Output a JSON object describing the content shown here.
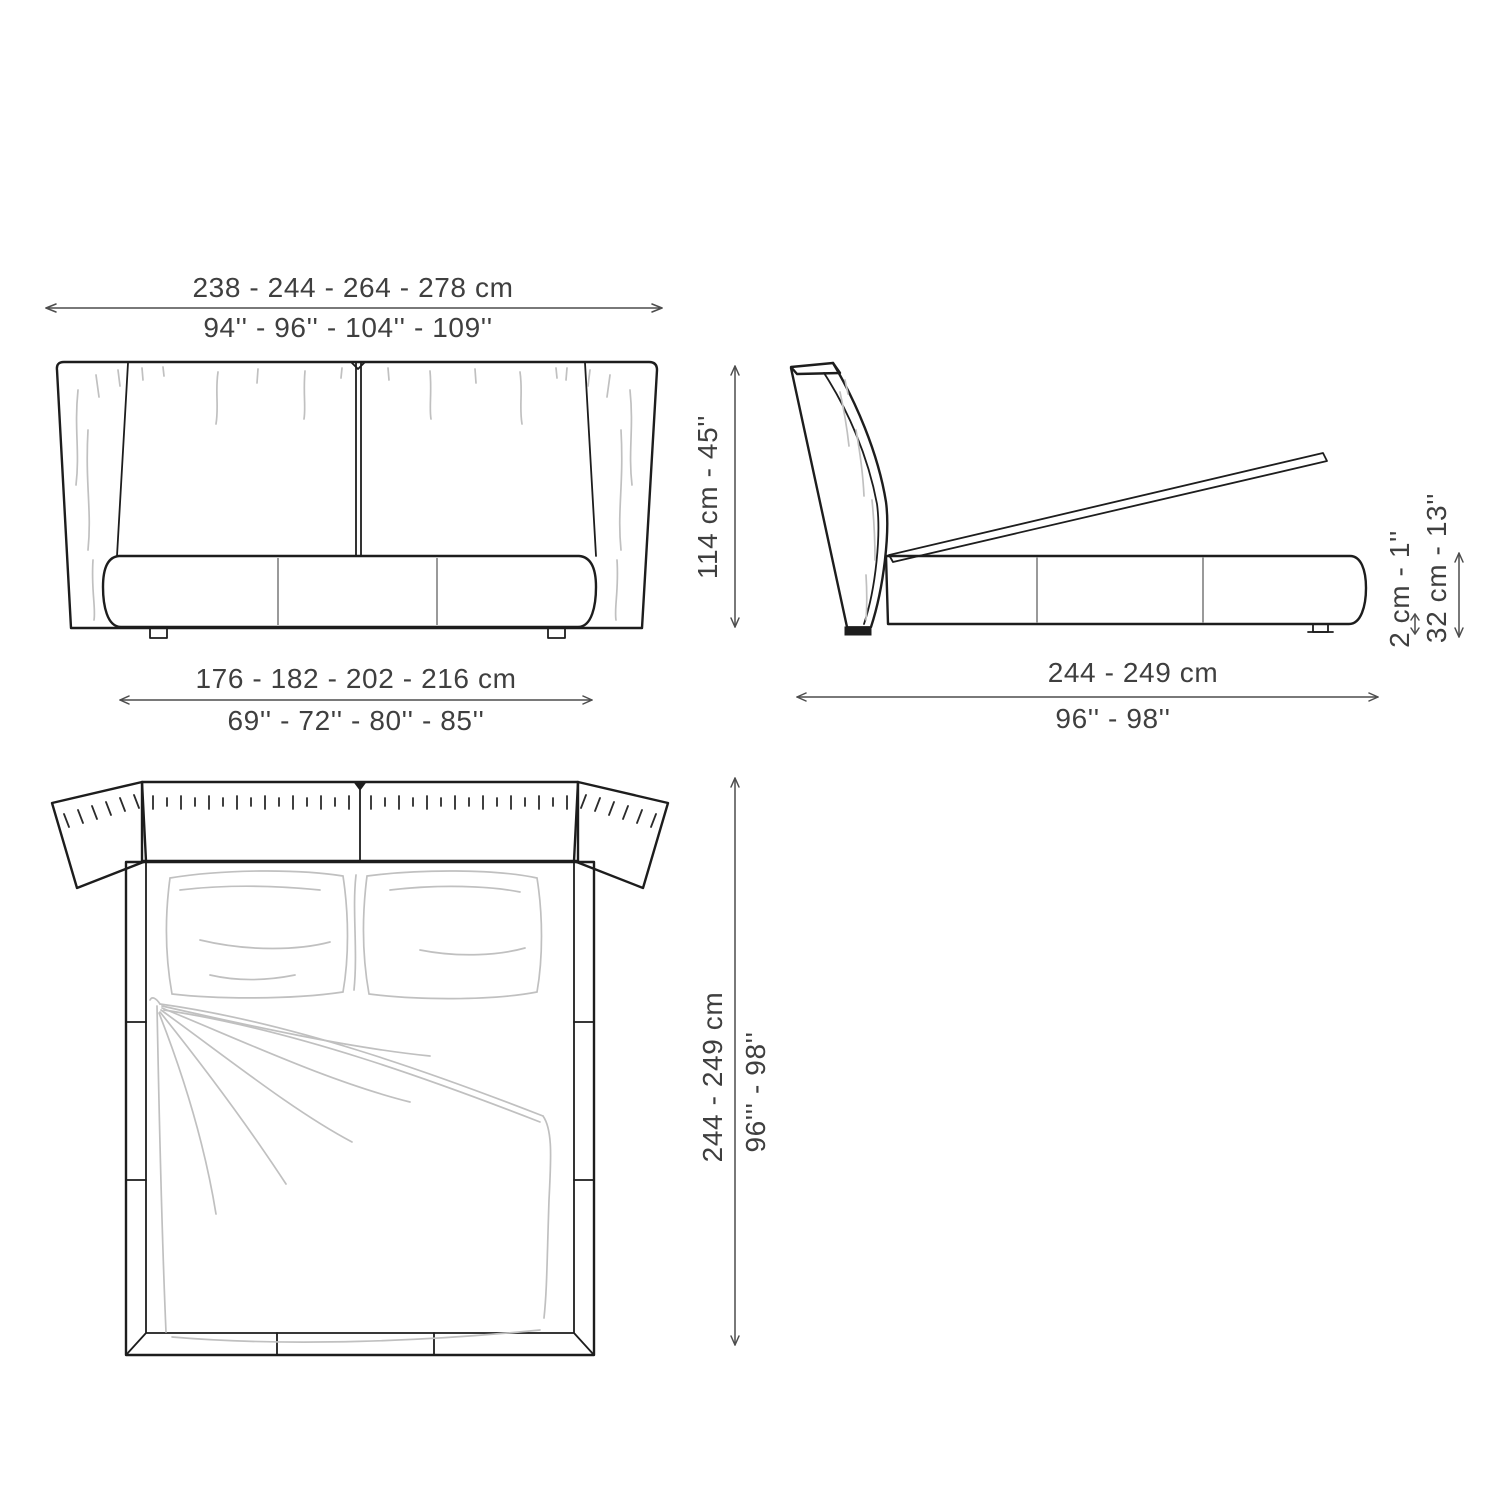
{
  "figure": {
    "type": "furniture technical drawing",
    "subject": "upholstered storage bed — front, side and top dimension views"
  },
  "views": {
    "front": {
      "overall_width_cm": "238 - 244 - 264 - 278 cm",
      "overall_width_in": "94'' - 96'' - 104'' - 109''",
      "base_width_cm": "176 - 182 - 202 - 216 cm",
      "base_width_in": "69'' - 72'' - 80'' - 85''",
      "height": "114 cm - 45''"
    },
    "side": {
      "depth_cm": "244 - 249 cm",
      "depth_in": "96'' - 98''",
      "floor_clearance": "2 cm - 1''",
      "storage_height": "32 cm - 13''"
    },
    "top": {
      "depth_cm": "244 - 249 cm",
      "depth_in": "96''' - 98''"
    }
  },
  "colors": {
    "line": "#1d1d1d",
    "dimension_line": "#4d4d4d",
    "sketch": "#c0c0c0",
    "text": "#3f3f3f",
    "background": "#ffffff"
  }
}
